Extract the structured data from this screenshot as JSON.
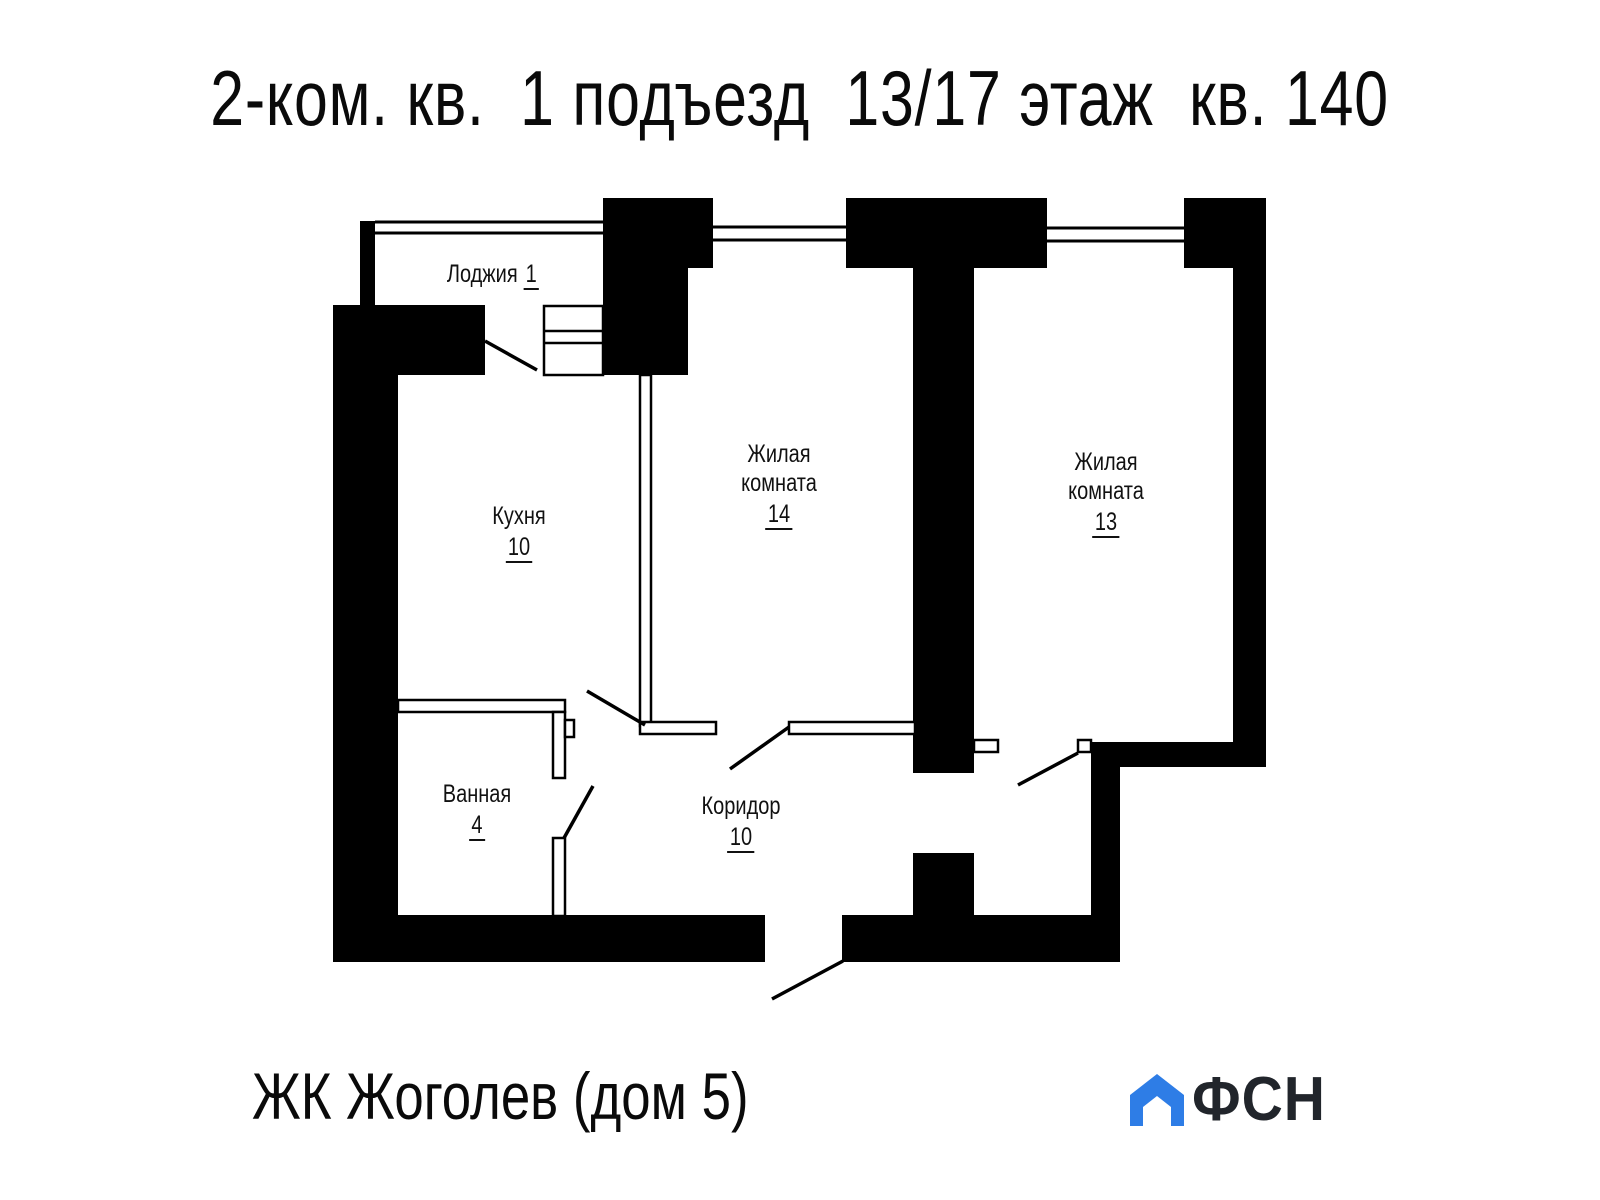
{
  "title": "2-ком. кв.  1 подъезд  13/17 этаж  кв. 140",
  "plan": {
    "rooms": {
      "loggia": {
        "name": "Лоджия",
        "area": "1"
      },
      "kitchen": {
        "name": "Кухня",
        "area": "10"
      },
      "room14": {
        "name_line1": "Жилая",
        "name_line2": "комната",
        "area": "14"
      },
      "room13": {
        "name_line1": "Жилая",
        "name_line2": "комната",
        "area": "13"
      },
      "bathroom": {
        "name": "Ванная",
        "area": "4"
      },
      "corridor": {
        "name": "Коридор",
        "area": "10"
      }
    }
  },
  "footer": {
    "project": "ЖК Жоголев (дом 5)"
  },
  "logo": {
    "text": "ФСН",
    "house_color": "#2e7de6",
    "text_color": "#21252b"
  },
  "colors": {
    "ink": "#000000",
    "background": "#ffffff"
  }
}
